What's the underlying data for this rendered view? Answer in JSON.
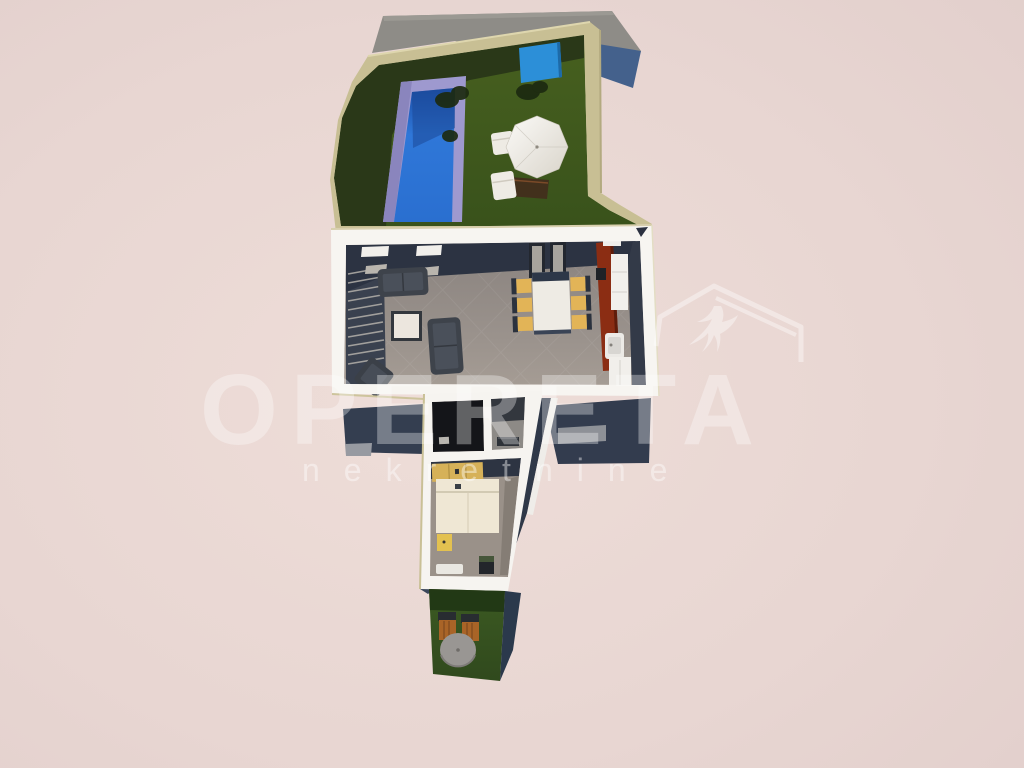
{
  "watermark": {
    "title": "OPERETA",
    "subtitle": "nekretnine",
    "logo": "roof-with-swallow-icon",
    "color": "#ffffff"
  },
  "scene": {
    "kind": "3d-aerial-cutaway-floor-plan-render",
    "areas": [
      "flat-roof",
      "pool-terrace",
      "swimming-pool",
      "parasol",
      "sun-loungers",
      "living-room",
      "staircase",
      "sofa",
      "armchair",
      "coffee-table",
      "dining-table",
      "dining-chairs",
      "kitchen",
      "hallway",
      "bathroom",
      "bedroom",
      "bed",
      "wardrobe",
      "nightstand",
      "dresser",
      "bench",
      "rear-garden",
      "garden-table",
      "garden-chairs"
    ]
  },
  "palette": {
    "background": "#e8d6d2",
    "wall_white": "#f7f5f1",
    "wall_tan": "#c8bf94",
    "inner_wall_navy": "#2c3342",
    "floor_gray": "#948d88",
    "grass_terrace": "#41581f",
    "grass_garden": "#3c5a22",
    "pool_water": "#2f77d8",
    "pool_deck_lavender": "#9e99cf",
    "roof_gray": "#8e8c87",
    "roof_shadow_blue": "#44618c",
    "kitchen_red": "#8b2d13",
    "chair_yellow": "#e2b457",
    "wood_orange": "#a96427",
    "shadow_navy": "#333c4e"
  }
}
